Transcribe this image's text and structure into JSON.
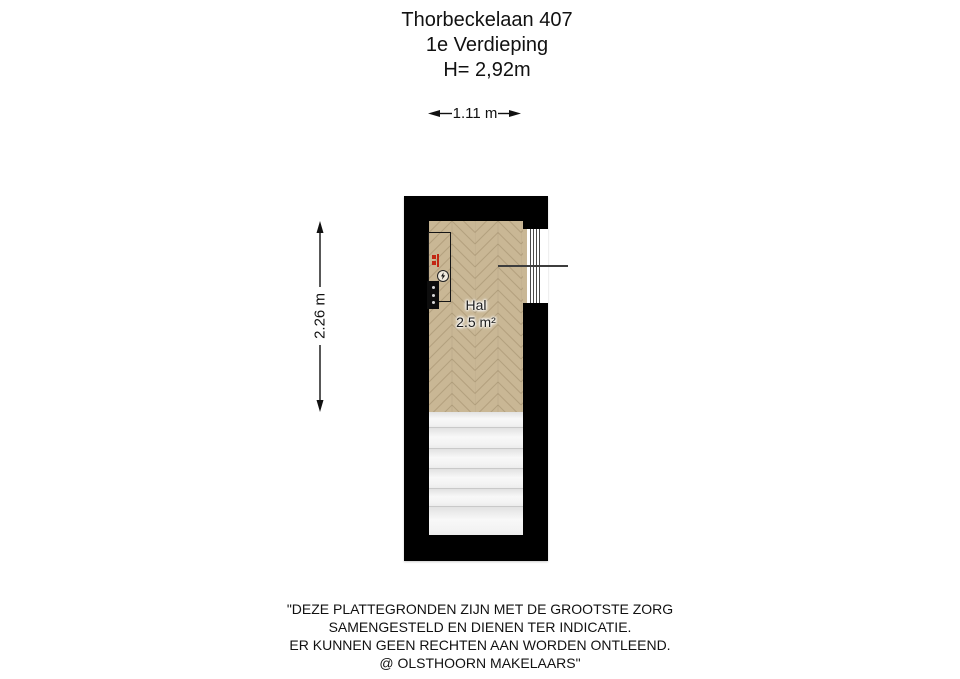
{
  "header": {
    "address": "Thorbeckelaan 407",
    "floor": "1e Verdieping",
    "ceiling_height": "H= 2,92m"
  },
  "dimensions": {
    "width_label": "1.11 m",
    "depth_label": "2.26 m"
  },
  "room": {
    "name": "Hal",
    "area": "2.5 m²"
  },
  "icons": {
    "electric_meter": "lightning-bolt-in-circle",
    "meter_panel": "black-panel-with-dots",
    "radiator": "red-radiator-symbol"
  },
  "colors": {
    "wall": "#000000",
    "floor_wood": "#c9b795",
    "floor_seam": "#b3a07e",
    "stairs": "#f2f2f2",
    "stair_line": "#c9c9c9",
    "door_line": "#3d3d3d",
    "meter_red": "#c22612"
  },
  "footer": {
    "line1": "\"DEZE PLATTEGRONDEN ZIJN MET DE GROOTSTE ZORG",
    "line2": "SAMENGESTELD EN DIENEN TER INDICATIE.",
    "line3": "ER KUNNEN GEEN RECHTEN AAN WORDEN ONTLEEND.",
    "line4": "@ OLSTHOORN MAKELAARS\""
  }
}
